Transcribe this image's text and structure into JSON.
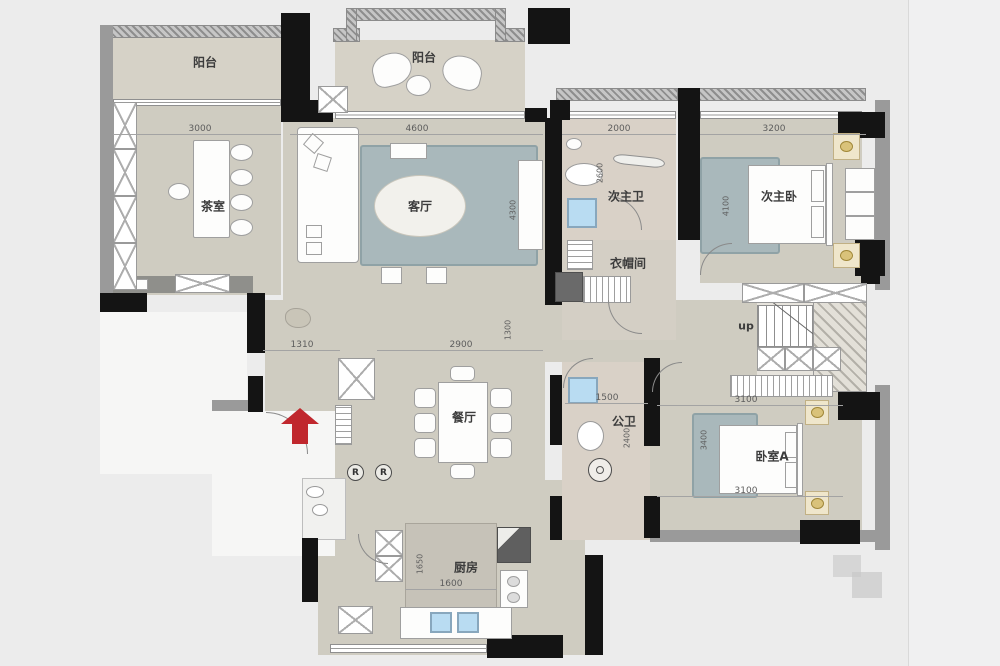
{
  "rooms": {
    "balcony_left": "阳台",
    "balcony_top": "阳台",
    "tea_room": "茶室",
    "living_room": "客厅",
    "second_master_bath": "次主卫",
    "second_master_bedroom": "次主卧",
    "cloakroom": "衣帽间",
    "stairs": "up",
    "dining_room": "餐厅",
    "public_bath": "公卫",
    "bedroom_a": "卧室A",
    "kitchen": "厨房"
  },
  "dimensions": {
    "tea_width": "3000",
    "living_width": "4600",
    "second_bath_width": "2000",
    "second_bedroom_width": "3200",
    "foyer_width": "1310",
    "dining_width": "2900",
    "public_bath_width": "1500",
    "bedroom_a_width_top": "3100",
    "bedroom_a_width_bottom": "3100",
    "kitchen_width": "1600",
    "living_depth": "4300",
    "hall_depth": "1300",
    "second_bedroom_depth": "4100",
    "second_bath_depth": "2600",
    "public_bath_depth": "2400",
    "kitchen_depth": "1650",
    "bedroom_a_depth": "3400"
  },
  "symbols": {
    "refrigerator": "R"
  },
  "colors": {
    "wall": "#141414",
    "floor": "#cfccc1",
    "balcony_floor": "#d6d2c7",
    "bath_floor": "#d9d1c7",
    "rug": "#a9b8bb",
    "entry_arrow": "#c0272d",
    "sink": "#b9dcf2",
    "gold_accent": "#c8a84b"
  }
}
